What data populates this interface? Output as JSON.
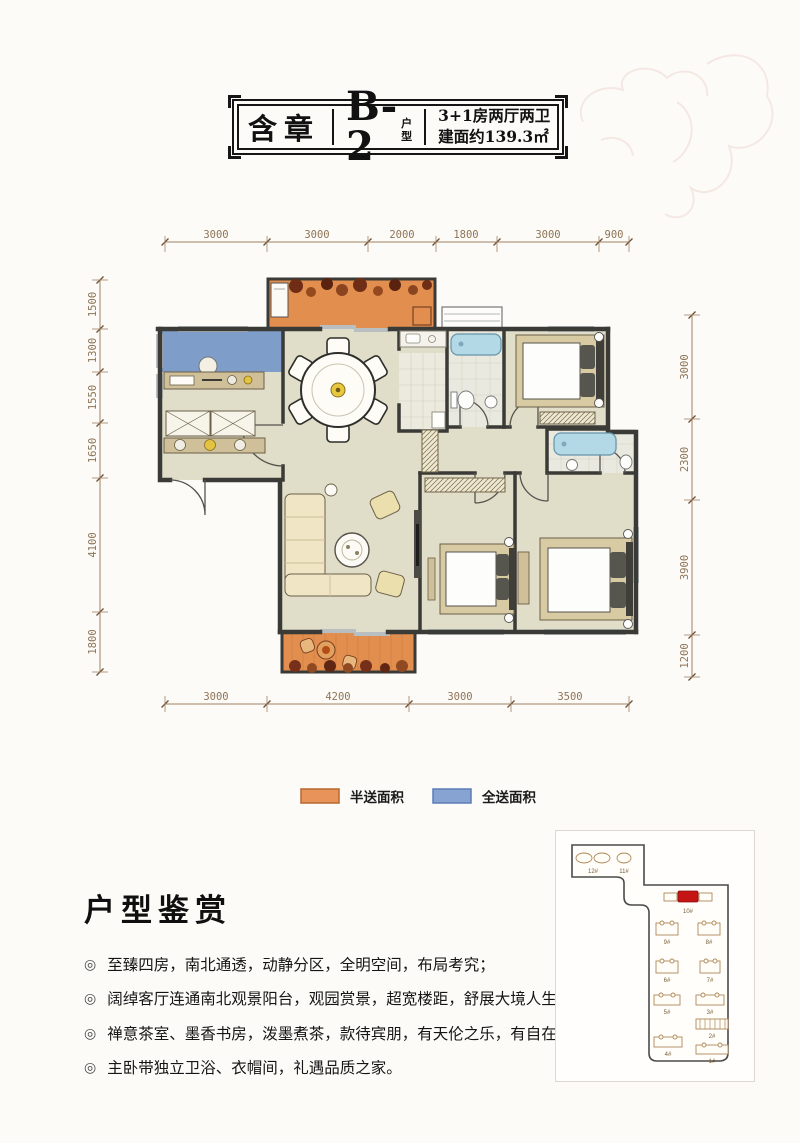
{
  "title_block": {
    "project_name": "含章",
    "unit_code": "B-2",
    "unit_suffix": "户型",
    "spec_line1": "3+1房两厅两卫",
    "spec_line2": "建面约139.3㎡"
  },
  "dimensions": {
    "top": [
      "3000",
      "3000",
      "2000",
      "1800",
      "3000",
      "900"
    ],
    "bottom": [
      "3000",
      "4200",
      "3000",
      "3500"
    ],
    "left": [
      "1500",
      "1300",
      "1550",
      "1650",
      "4100",
      "1800"
    ],
    "right": [
      "3000",
      "2300",
      "3900",
      "1200"
    ]
  },
  "legend": [
    {
      "label": "半送面积",
      "color": "#e8935a"
    },
    {
      "label": "全送面积",
      "color": "#87a3d2"
    }
  ],
  "appreciation": {
    "heading": "户型鉴赏",
    "bullets": [
      "至臻四房，南北通透，动静分区，全明空间，布局考究；",
      "阔绰客厅连通南北观景阳台，观园赏景，超宽楼距，舒展大境人生；",
      "禅意茶室、墨香书房，泼墨煮茶，款待宾朋，有天伦之乐，有自在生活；",
      "主卧带独立卫浴、衣帽间，礼遇品质之家。"
    ]
  },
  "site_map": {
    "highlight_color": "#c41414",
    "highlighted": "10#",
    "buildings": [
      "12#",
      "11#",
      "10#",
      "9#",
      "8#",
      "6#",
      "7#",
      "5#",
      "3#",
      "2#",
      "4#",
      "1#"
    ]
  }
}
